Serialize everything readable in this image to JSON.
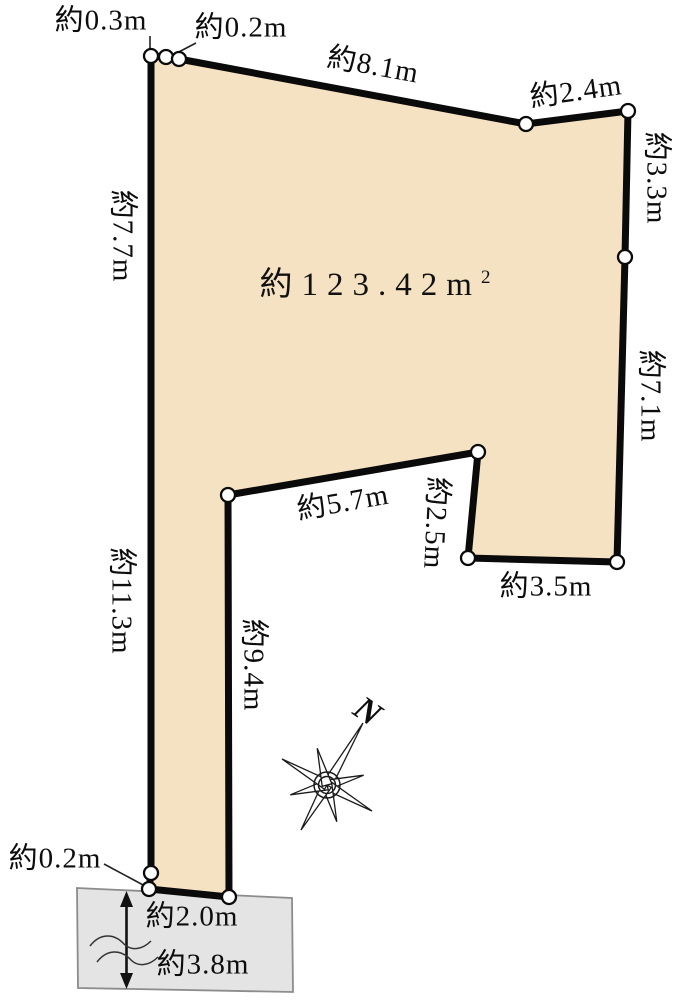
{
  "lot": {
    "area_value": "約123.42",
    "area_unit_base": "m",
    "area_unit_exponent": "2",
    "compass_north": "N",
    "measurements": {
      "top_left_a": "約0.3m",
      "top_left_b": "約0.2m",
      "top": "約8.1m",
      "top_right": "約2.4m",
      "right_upper": "約3.3m",
      "right_lower": "約7.1m",
      "left_upper": "約7.7m",
      "left_lower": "約11.3m",
      "notch_top": "約5.7m",
      "notch_right": "約2.5m",
      "notch_bottom": "約3.5m",
      "strip_right": "約9.4m",
      "bottom_left": "約0.2m",
      "road_width_near": "約2.0m",
      "road_width_far": "約3.8m"
    }
  },
  "colors": {
    "lot_fill": "#f5e2c2",
    "lot_outline": "#0a0a0a",
    "road_fill": "#e4e4e4",
    "road_border": "#8c8c8c",
    "vertex_fill": "#ffffff"
  }
}
